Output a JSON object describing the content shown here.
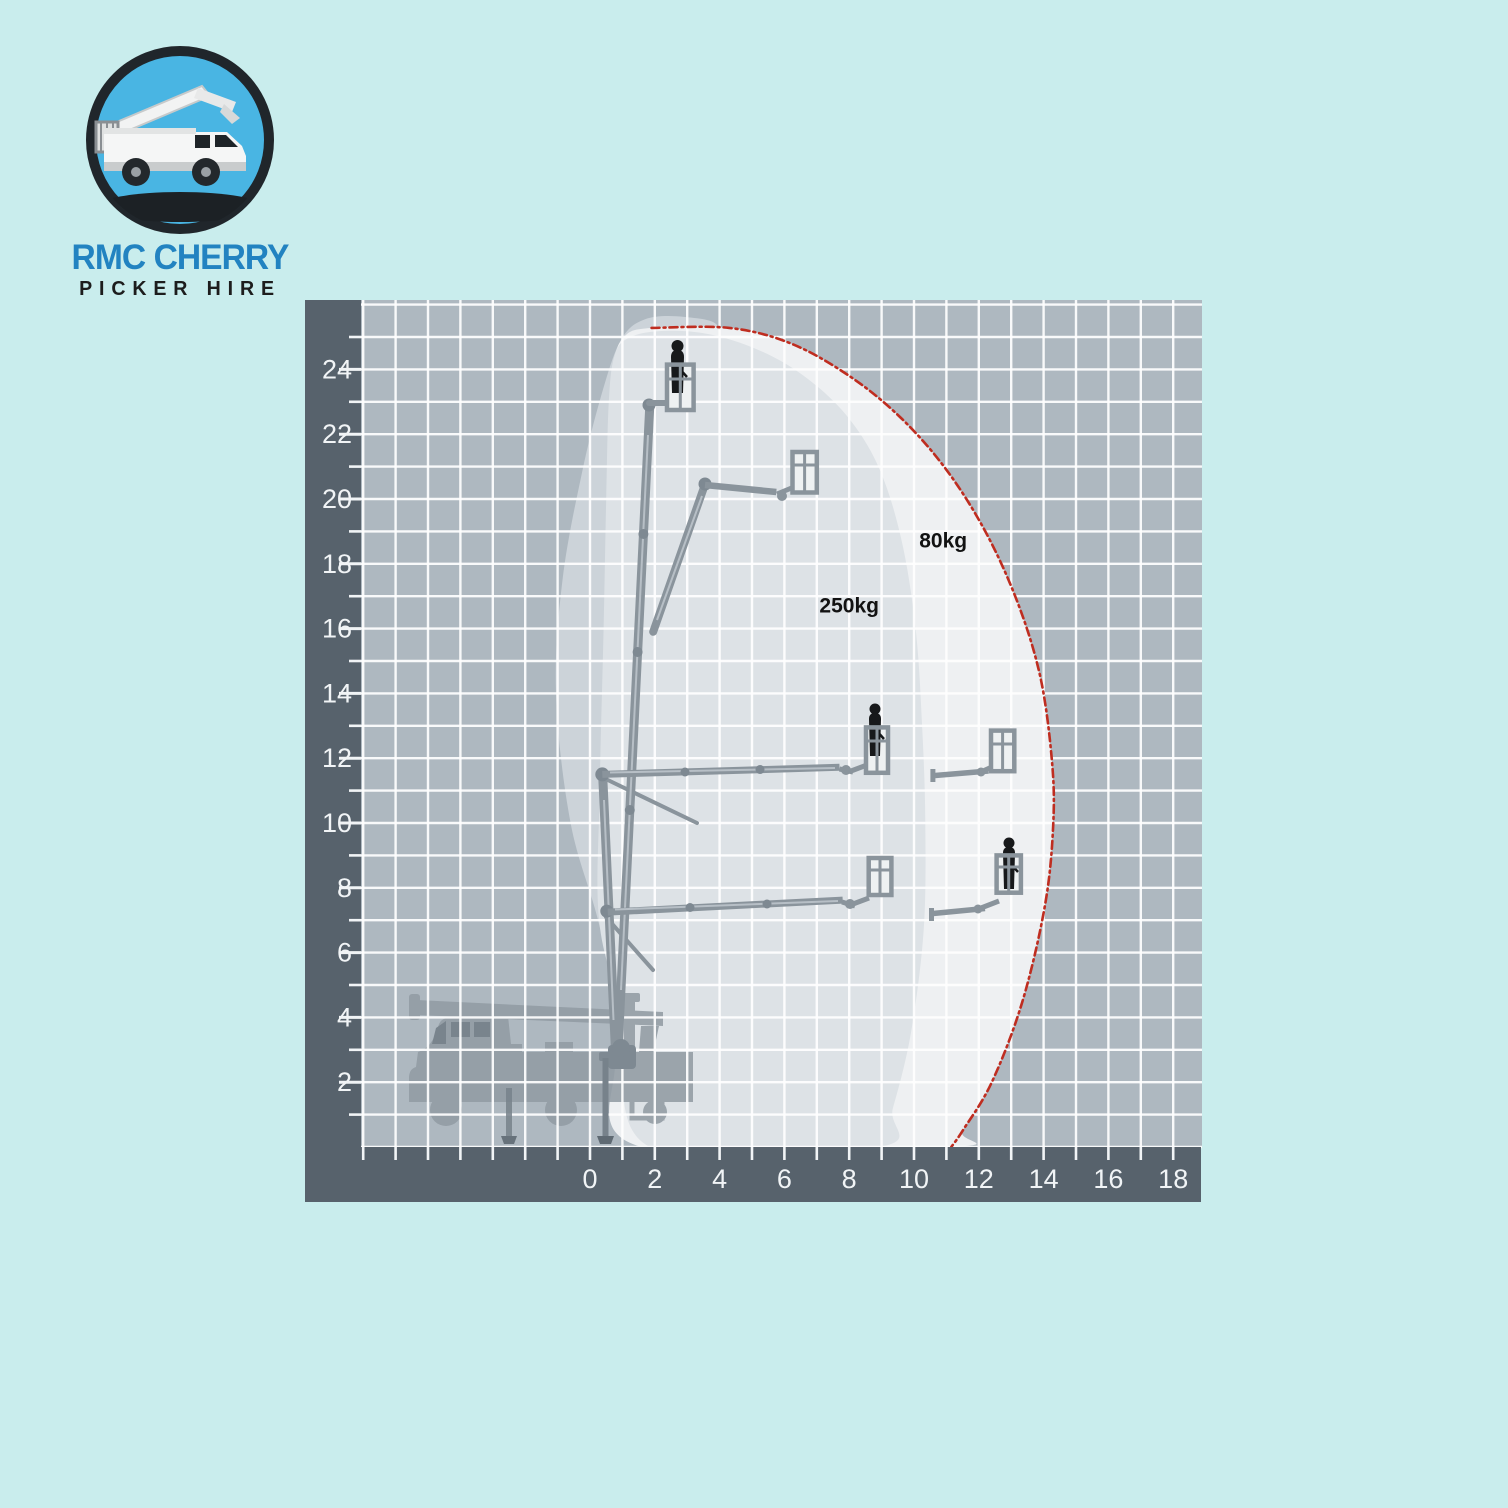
{
  "page": {
    "background": "#c9eded"
  },
  "logo": {
    "line1": "RMC CHERRY",
    "line2": "PICKER HIRE",
    "line1_color": "#2283c1",
    "line2_color": "#1d1d1d",
    "ring_color": "#20262b",
    "sky_color": "#49b5e3"
  },
  "chart_data": {
    "type": "area",
    "title": "",
    "xlabel": "",
    "ylabel": "",
    "x_range": [
      -7,
      19
    ],
    "y_range": [
      0,
      26.1
    ],
    "grid": true,
    "x_tick_labels": [
      0,
      2,
      4,
      6,
      8,
      10,
      12,
      14,
      16,
      18
    ],
    "y_tick_labels": [
      2,
      4,
      6,
      8,
      10,
      12,
      14,
      16,
      18,
      20,
      22,
      24
    ],
    "axis_band_color": "#57626c",
    "grid_bg_color": "#aeb8c0",
    "gridline_color": "#ffffff",
    "zones": [
      {
        "id": "shadow",
        "label": "",
        "color": "#ccd3d9",
        "points": [
          [
            1.9,
            0.2
          ],
          [
            1.2,
            2.6
          ],
          [
            0.3,
            6.8
          ],
          [
            -0.6,
            10.0
          ],
          [
            -1.05,
            14.0
          ],
          [
            -0.85,
            17.5
          ],
          [
            -0.25,
            20.8
          ],
          [
            0.35,
            23.2
          ],
          [
            0.95,
            24.9
          ],
          [
            1.7,
            25.55
          ],
          [
            2.9,
            25.62
          ],
          [
            3.95,
            25.3
          ],
          [
            3.2,
            24.1
          ],
          [
            2.62,
            22.0
          ],
          [
            2.3,
            18.0
          ],
          [
            2.2,
            13.0
          ],
          [
            2.35,
            8.0
          ],
          [
            2.5,
            4.0
          ],
          [
            2.4,
            1.0
          ]
        ]
      },
      {
        "id": "envelope-80kg",
        "label": "80kg",
        "label_pos": [
          10.9,
          18.5
        ],
        "color": "#eef0f2",
        "points": [
          [
            1.6,
            0.0
          ],
          [
            0.75,
            2.8
          ],
          [
            0.55,
            6.0
          ],
          [
            0.45,
            10.0
          ],
          [
            0.45,
            14.0
          ],
          [
            0.5,
            18.0
          ],
          [
            0.55,
            21.5
          ],
          [
            0.7,
            24.0
          ],
          [
            1.05,
            25.0
          ],
          [
            1.9,
            25.28
          ],
          [
            4.3,
            25.28
          ],
          [
            6.2,
            24.8
          ],
          [
            8.0,
            23.8
          ],
          [
            9.6,
            22.5
          ],
          [
            11.0,
            20.9
          ],
          [
            12.2,
            19.0
          ],
          [
            13.2,
            16.8
          ],
          [
            13.9,
            14.5
          ],
          [
            14.25,
            12.0
          ],
          [
            14.3,
            10.0
          ],
          [
            14.05,
            7.5
          ],
          [
            13.35,
            4.5
          ],
          [
            12.4,
            2.0
          ],
          [
            11.5,
            0.5
          ],
          [
            11.15,
            0.0
          ]
        ]
      },
      {
        "id": "envelope-250kg",
        "label": "250kg",
        "label_pos": [
          8.0,
          16.5
        ],
        "color": "#dde2e6",
        "points": [
          [
            1.85,
            0.0
          ],
          [
            1.0,
            4.0
          ],
          [
            0.28,
            7.0
          ],
          [
            0.3,
            11.0
          ],
          [
            0.42,
            16.0
          ],
          [
            0.5,
            20.0
          ],
          [
            0.58,
            23.0
          ],
          [
            0.75,
            24.4
          ],
          [
            1.15,
            24.95
          ],
          [
            2.1,
            25.18
          ],
          [
            3.6,
            25.1
          ],
          [
            5.2,
            24.6
          ],
          [
            6.6,
            23.8
          ],
          [
            7.9,
            22.6
          ],
          [
            8.9,
            21.0
          ],
          [
            9.6,
            18.8
          ],
          [
            10.05,
            16.0
          ],
          [
            10.25,
            13.0
          ],
          [
            10.35,
            10.0
          ],
          [
            10.3,
            6.7
          ],
          [
            9.9,
            3.5
          ],
          [
            9.35,
            1.2
          ],
          [
            8.9,
            0.0
          ]
        ]
      }
    ],
    "limit_line": {
      "color": "#bf2d20",
      "style": "dash-dot",
      "points": [
        [
          1.9,
          25.28
        ],
        [
          4.3,
          25.28
        ],
        [
          6.2,
          24.8
        ],
        [
          8.0,
          23.8
        ],
        [
          9.6,
          22.5
        ],
        [
          11.0,
          20.9
        ],
        [
          12.2,
          19.0
        ],
        [
          13.2,
          16.8
        ],
        [
          13.9,
          14.5
        ],
        [
          14.25,
          12.0
        ],
        [
          14.3,
          10.0
        ],
        [
          14.05,
          7.5
        ],
        [
          13.35,
          4.5
        ],
        [
          12.4,
          2.0
        ],
        [
          11.5,
          0.5
        ],
        [
          11.15,
          0.0
        ]
      ]
    },
    "platform_positions": [
      {
        "outreach": 2.7,
        "height": 24.0,
        "occupied": true
      },
      {
        "outreach": 6.6,
        "height": 20.8,
        "occupied": false
      },
      {
        "outreach": 8.8,
        "height": 12.2,
        "occupied": true
      },
      {
        "outreach": 12.7,
        "height": 12.2,
        "occupied": false
      },
      {
        "outreach": 9.0,
        "height": 8.3,
        "occupied": false
      },
      {
        "outreach": 12.9,
        "height": 8.3,
        "occupied": true
      }
    ]
  }
}
